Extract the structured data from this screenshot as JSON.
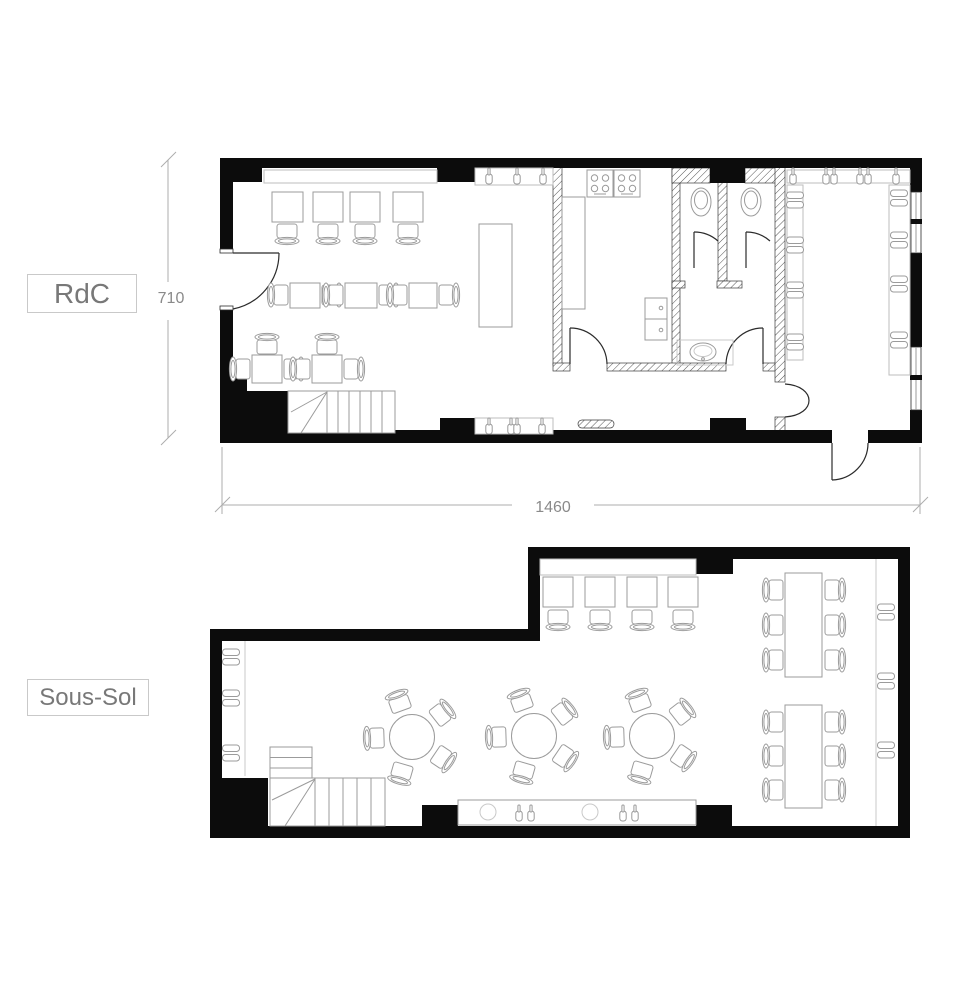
{
  "page": {
    "background": "#ffffff",
    "type": "architectural-floor-plans"
  },
  "labels": {
    "rdc": "RdC",
    "sous_sol": "Sous-Sol"
  },
  "dimensions": {
    "rdc_height": "710",
    "rdc_width": "1460"
  },
  "colors": {
    "wall": "#0c0c0c",
    "furniture_outline": "#9b9b9b",
    "dimension_line": "#adadad",
    "label_text": "#787878"
  },
  "icons": [
    "table-icon",
    "chair-icon",
    "round-table-icon",
    "stove-icon",
    "sink-icon",
    "toilet-icon",
    "stairs-icon",
    "bottle-icon",
    "bench-icon",
    "door-swing-icon",
    "radiator-icon"
  ]
}
